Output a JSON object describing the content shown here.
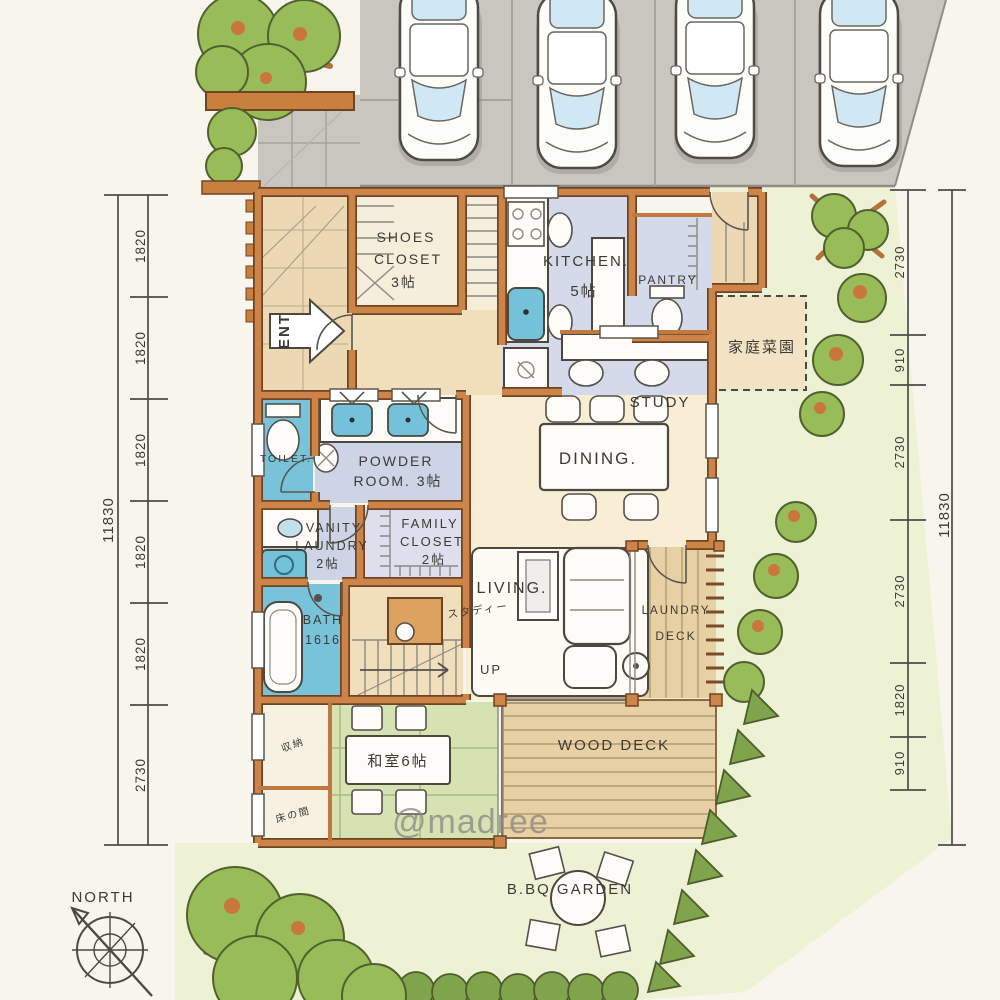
{
  "meta": {
    "watermark": "@madree"
  },
  "compass": {
    "label": "NORTH"
  },
  "parking": {
    "car_count": "4"
  },
  "rooms": {
    "entrance": {
      "arrow": "ENT"
    },
    "shoes_closet": {
      "l1": "SHOES",
      "l2": "CLOSET",
      "size": "3帖"
    },
    "kitchen": {
      "name": "KITCHEN.",
      "size": "5帖"
    },
    "pantry": {
      "name": "PANTRY"
    },
    "study": {
      "name": "STUDY"
    },
    "dining": {
      "name": "DINING."
    },
    "powder": {
      "l1": "POWDER",
      "l2": "ROOM. 3帖"
    },
    "toilet": {
      "name": "TOILET."
    },
    "vanity": {
      "l1": "VANITY",
      "l2": "LAUNDRY",
      "l3": "2帖"
    },
    "family_closet": {
      "l1": "FAMILY",
      "l2": "CLOSET",
      "l3": "2帖"
    },
    "bath": {
      "l1": "BATH",
      "l2": "1616"
    },
    "stairs": {
      "up": "UP",
      "desk_note": "スタディー"
    },
    "living": {
      "name": "LIVING."
    },
    "laundry_deck": {
      "l1": "LAUNDRY",
      "l2": "DECK"
    },
    "wood_deck": {
      "name": "WOOD DECK"
    },
    "tatami": {
      "name": "和室6帖",
      "storage": "収納",
      "alcove": "床の間"
    },
    "vegetable_garden": {
      "name": "家庭菜園"
    },
    "bbq": {
      "name": "B.BQ GARDEN"
    }
  },
  "dimensions": {
    "left": {
      "total": "11830",
      "segments": [
        "1820",
        "1820",
        "1820",
        "1820",
        "1820",
        "2730"
      ]
    },
    "right": {
      "total": "11830",
      "segments": [
        "2730",
        "910",
        "2730",
        "2730",
        "1820",
        "910"
      ]
    }
  },
  "colors": {
    "wall": "#cd8449",
    "water": "#74c2da",
    "kitchen_floor": "#d4daea",
    "tatami": "#d6e2b2",
    "deck": "#e7d0a4",
    "paving": "#c8c6bf",
    "garden": "#eef2d5",
    "foliage": "#98bc57",
    "paper": "#f8f5ec"
  }
}
